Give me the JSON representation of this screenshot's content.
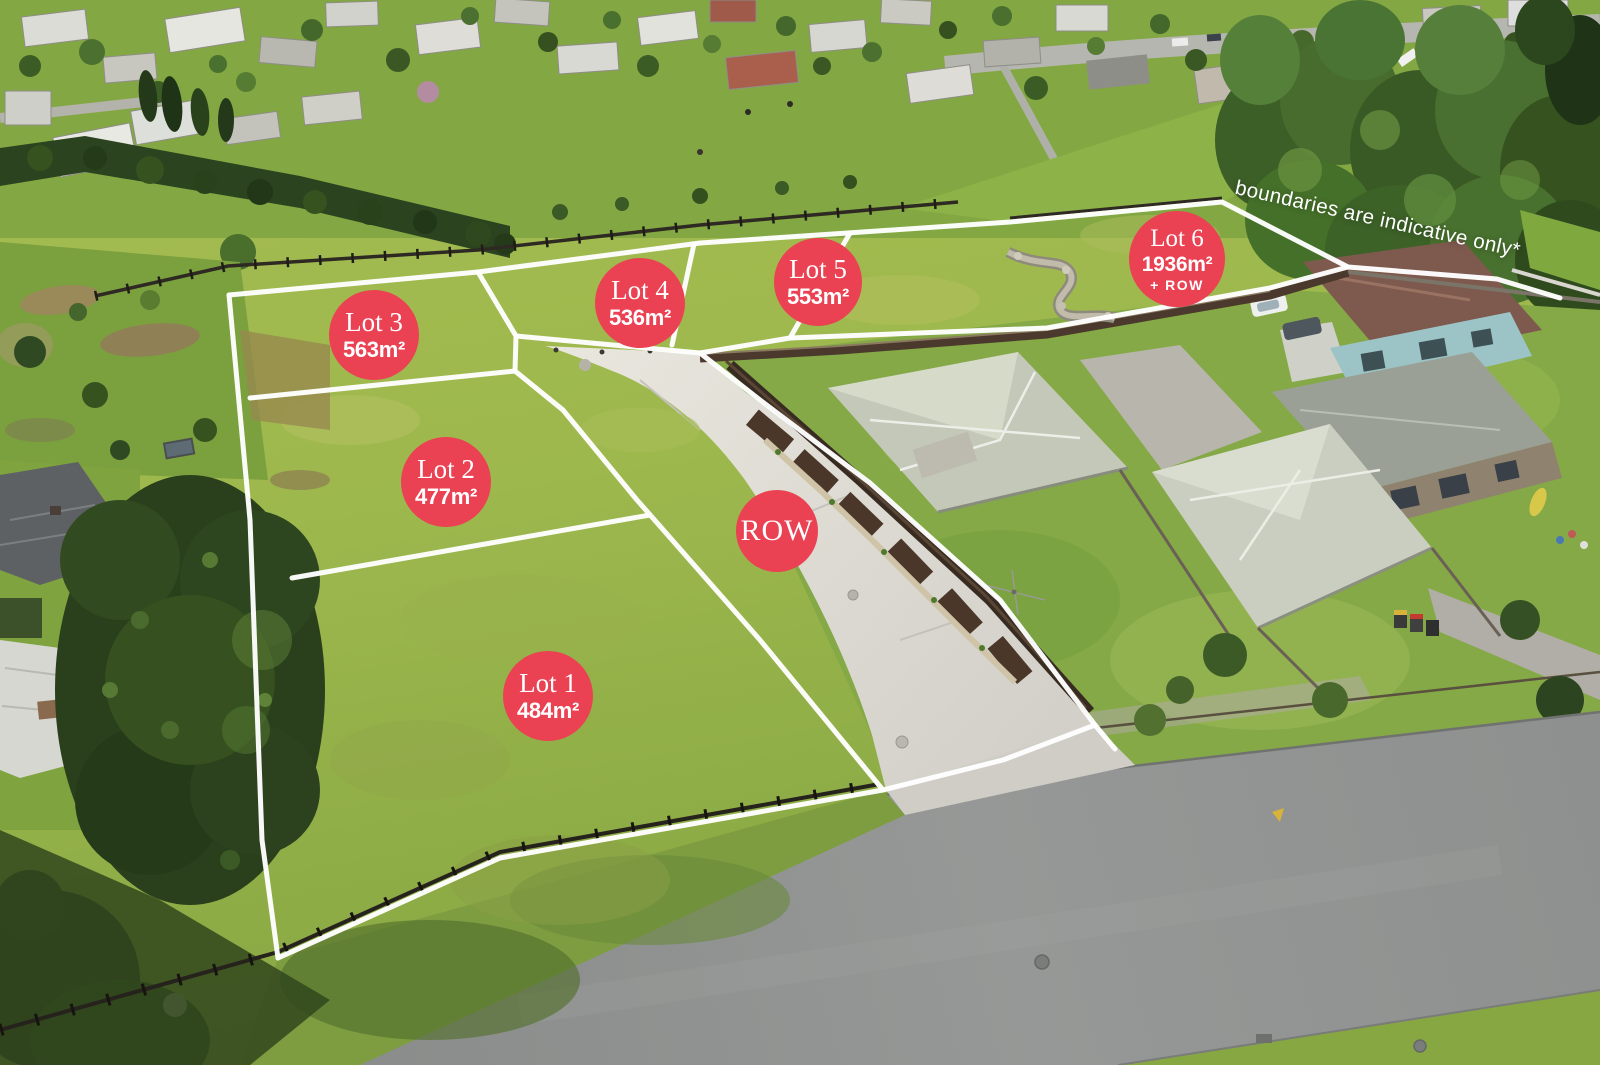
{
  "colors": {
    "badge_red": "#ea4153",
    "boundary_line": "#ffffff"
  },
  "lots": [
    {
      "label": "Lot 1",
      "area": "484m²",
      "cx": 548,
      "cy": 696,
      "d": 90
    },
    {
      "label": "Lot 2",
      "area": "477m²",
      "cx": 446,
      "cy": 482,
      "d": 90
    },
    {
      "label": "Lot 3",
      "area": "563m²",
      "cx": 374,
      "cy": 335,
      "d": 90
    },
    {
      "label": "Lot 4",
      "area": "536m²",
      "cx": 640,
      "cy": 303,
      "d": 90
    },
    {
      "label": "Lot 5",
      "area": "553m²",
      "cx": 818,
      "cy": 282,
      "d": 88
    },
    {
      "label": "Lot 6",
      "area": "1936m²",
      "extra": "+ ROW",
      "cx": 1177,
      "cy": 259,
      "d": 96
    }
  ],
  "row_marker": {
    "label": "ROW",
    "cx": 777,
    "cy": 531,
    "d": 82
  },
  "disclaimer": "boundaries are indicative only*",
  "boundaries": {
    "stroke_width": 5,
    "polylines": [
      [
        [
          229,
          295
        ],
        [
          478,
          272
        ],
        [
          700,
          243
        ],
        [
          1010,
          222
        ],
        [
          1222,
          202
        ],
        [
          1348,
          267
        ],
        [
          1497,
          279
        ],
        [
          1560,
          298
        ]
      ],
      [
        [
          229,
          295
        ],
        [
          250,
          520
        ],
        [
          262,
          840
        ],
        [
          278,
          958
        ]
      ],
      [
        [
          278,
          958
        ],
        [
          500,
          858
        ],
        [
          883,
          790
        ]
      ],
      [
        [
          883,
          790
        ],
        [
          1003,
          760
        ],
        [
          1095,
          725
        ],
        [
          1115,
          749
        ]
      ],
      [
        [
          1095,
          725
        ],
        [
          1000,
          600
        ],
        [
          870,
          483
        ],
        [
          760,
          400
        ],
        [
          700,
          353
        ]
      ],
      [
        [
          700,
          353
        ],
        [
          790,
          338
        ],
        [
          1047,
          328
        ],
        [
          1270,
          288
        ],
        [
          1348,
          267
        ]
      ],
      [
        [
          883,
          790
        ],
        [
          760,
          640
        ],
        [
          637,
          500
        ],
        [
          563,
          410
        ],
        [
          515,
          371
        ]
      ],
      [
        [
          250,
          398
        ],
        [
          515,
          371
        ]
      ],
      [
        [
          292,
          578
        ],
        [
          650,
          515
        ]
      ],
      [
        [
          478,
          272
        ],
        [
          516,
          336
        ],
        [
          515,
          371
        ]
      ],
      [
        [
          516,
          336
        ],
        [
          700,
          353
        ]
      ],
      [
        [
          694,
          244
        ],
        [
          672,
          345
        ]
      ],
      [
        [
          850,
          233
        ],
        [
          790,
          338
        ]
      ]
    ]
  }
}
